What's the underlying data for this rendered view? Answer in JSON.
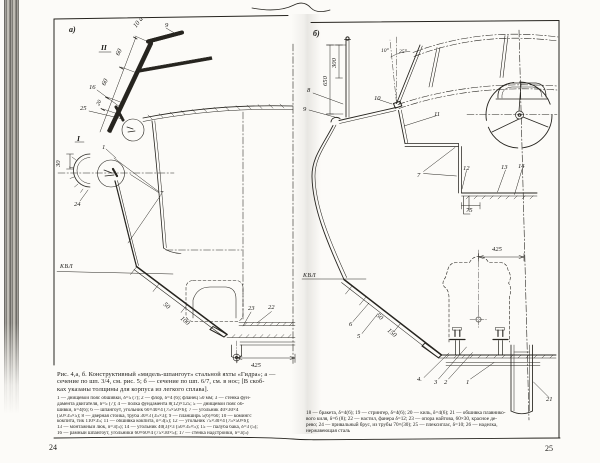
{
  "page": {
    "left_number": "24",
    "right_number": "25"
  },
  "colors": {
    "ink": "#26241f",
    "paper": "#fcfbf8"
  },
  "caption": {
    "lines": [
      "Рис. 4,а, б. Конструктивный «мидель-шпангоут» стальной яхты «Гидра»; а —",
      "сечение по шп. 3/4, см. рис. 5; б — сечение по шп. 6/7, см. в нос; [В скоб-",
      "ках указаны толщины для корпуса из легкого сплава]."
    ]
  },
  "legend_left": {
    "lines": [
      "1 — днищевой пояс обшивки, δ=5 (7); 2 — флор, δ=4 (6); фланец 50 мм; 3 — стенка фун-",
      "дамента двигателя, δ=5 (7); 4 — полка фундамента 8(12)×125; 5 — днищевой пояс об-",
      "шивки, δ=4(6); 6 — шпангоут, угольник 60×40×4 (75×50×6); 7 — угольник 40×30×4",
      "(50×35×5); 8 — дверная стойка, труба 30×3 (35×3); 9 — планширь 5(6)×60; 10 — комингс",
      "кокпита, тик 110×35; 11 — обшивка кокпита, δ=3(5); 12 — угольник 75×30×4 (75×50×6);",
      "13 — монтажный люк, δ=3(5); 14 — угольник 40(3)×3 (50×35×5); 15 — палуба бака, δ=3 (5);",
      "16 — рамный шпангоут, угольники 60×60×4 (75×30×5); 17 — стенка надстройки, δ=3(5)"
    ]
  },
  "legend_right": {
    "lines": [
      "18 — бракета, δ=4(6); 19 — стрингер, δ=4(6); 20 — киль, δ=4(6); 21 — обшивка плавнико-",
      "вого киля, δ=6 (8); 22 — настил, фанера δ=12; 23 — опора найтова, 60×30, красное де-",
      "рево; 24 — привальный брус, из трубы 70×(30); 25 — плексиглас, δ=10; 26 — наделка,",
      "нержавеющая сталь"
    ]
  },
  "diagram_a": {
    "title": "сечение по шп. 3/4",
    "labels": [
      {
        "t": "а)",
        "x": 69,
        "y": 32,
        "s": "panel"
      },
      {
        "t": "II",
        "x": 101,
        "y": 50,
        "s": "roman"
      },
      {
        "t": "9",
        "x": 165,
        "y": 27
      },
      {
        "t": "10 а",
        "x": 136,
        "y": 28,
        "r": -52
      },
      {
        "t": "60",
        "x": 119,
        "y": 56,
        "r": -64
      },
      {
        "t": "60",
        "x": 105,
        "y": 86,
        "r": -64
      },
      {
        "t": "20",
        "x": 99,
        "y": 106,
        "r": -64,
        "s": "small"
      },
      {
        "t": "16",
        "x": 89,
        "y": 89
      },
      {
        "t": "25",
        "x": 80,
        "y": 110
      },
      {
        "t": "I",
        "x": 77,
        "y": 141,
        "s": "roman"
      },
      {
        "t": "1",
        "x": 102,
        "y": 149
      },
      {
        "t": "30",
        "x": 60,
        "y": 167,
        "r": -90
      },
      {
        "t": "24",
        "x": 74,
        "y": 206
      },
      {
        "t": "7",
        "x": 160,
        "y": 195
      },
      {
        "t": "КВЛ",
        "x": 60,
        "y": 268,
        "s": "wl"
      },
      {
        "t": "50",
        "x": 163,
        "y": 305,
        "r": 40
      },
      {
        "t": "100",
        "x": 180,
        "y": 319,
        "r": 40
      },
      {
        "t": "23",
        "x": 248,
        "y": 310
      },
      {
        "t": "22",
        "x": 268,
        "y": 309
      },
      {
        "t": "425",
        "x": 251,
        "y": 367
      }
    ]
  },
  "diagram_b": {
    "title": "сечение по шп. 6/7",
    "labels": [
      {
        "t": "б)",
        "x": 313,
        "y": 36,
        "s": "panel"
      },
      {
        "t": "300",
        "x": 336,
        "y": 68,
        "r": -90
      },
      {
        "t": "650",
        "x": 327,
        "y": 86,
        "r": -90
      },
      {
        "t": "8",
        "x": 307,
        "y": 92
      },
      {
        "t": "9",
        "x": 303,
        "y": 111
      },
      {
        "t": "10°",
        "x": 381,
        "y": 52,
        "s": "small"
      },
      {
        "t": "25°",
        "x": 399,
        "y": 53,
        "s": "small"
      },
      {
        "t": "10",
        "x": 374,
        "y": 100
      },
      {
        "t": "11",
        "x": 434,
        "y": 116
      },
      {
        "t": "7",
        "x": 417,
        "y": 177
      },
      {
        "t": "12",
        "x": 463,
        "y": 170
      },
      {
        "t": "13",
        "x": 501,
        "y": 169
      },
      {
        "t": "14",
        "x": 518,
        "y": 168
      },
      {
        "t": "75",
        "x": 466,
        "y": 212
      },
      {
        "t": "КВЛ",
        "x": 303,
        "y": 277,
        "s": "wl"
      },
      {
        "t": "6",
        "x": 349,
        "y": 326
      },
      {
        "t": "5",
        "x": 357,
        "y": 338
      },
      {
        "t": "50",
        "x": 376,
        "y": 316,
        "r": 40
      },
      {
        "t": "150",
        "x": 387,
        "y": 331,
        "r": 40
      },
      {
        "t": "425",
        "x": 492,
        "y": 251
      },
      {
        "t": "4.",
        "x": 417,
        "y": 381
      },
      {
        "t": "3",
        "x": 434,
        "y": 384
      },
      {
        "t": "2",
        "x": 444,
        "y": 384
      },
      {
        "t": "1",
        "x": 466,
        "y": 384
      },
      {
        "t": "21",
        "x": 546,
        "y": 401
      }
    ]
  }
}
